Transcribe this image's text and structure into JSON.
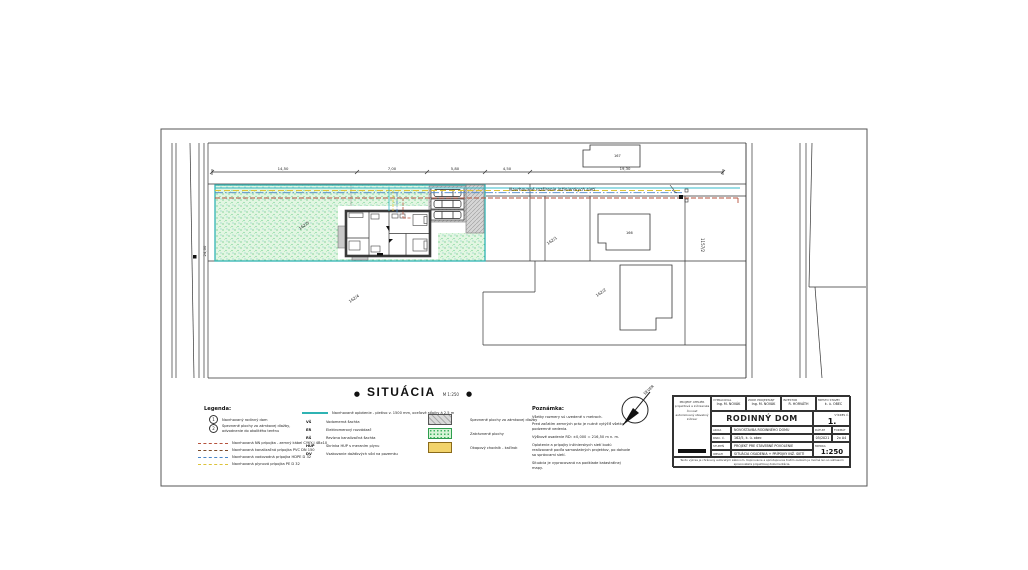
{
  "sheet": {
    "title": "SITUÁCIA",
    "scale_note": "M 1:250",
    "bullet": "●"
  },
  "drawing": {
    "street_label": "Navrhované rozšírenie inžinierskych sietí",
    "north_label": "SEVER",
    "dim_left": "24,00",
    "dims_top": [
      "14,50",
      "7,00",
      "5,80",
      "4,50",
      "19,30"
    ],
    "parcels": {
      "green": "162/5",
      "left": "162/4",
      "mid": "162/1",
      "mid2": "162/2",
      "top_building": "167",
      "building": "166",
      "road": "1157/2"
    }
  },
  "legend": {
    "header": "Legenda:",
    "numbered": [
      {
        "num": "1",
        "label": "Navrhovaný rodinný dom"
      },
      {
        "num": "2",
        "label": "Spevnené plochy zo zámkovej dlažby, odvodnenie do okolitého terénu"
      }
    ],
    "lines": [
      {
        "label": "Navrhovaná NN prípojka - zemný kábel CYKY-J 4Bx10"
      },
      {
        "label": "Navrhovaná kanalizačná prípojka PVC DN 150"
      },
      {
        "label": "Navrhovaná vodovodná prípojka HDPE D 32"
      },
      {
        "label": "Navrhovaná plynová prípojka PE D 32"
      }
    ],
    "fence_label": "Navrhované oplotenie - pletivo v. 1500 mm, oceľové stĺpiky á 2,5 m",
    "symbols": [
      {
        "sym": "VŠ",
        "label": "Vodomerná šachta"
      },
      {
        "sym": "ER",
        "label": "Elektromerový rozvádzač"
      },
      {
        "sym": "RŠ",
        "label": "Revízna kanalizačná šachta"
      },
      {
        "sym": "HUP",
        "label": "Skrinka HUP s meraním plynu"
      },
      {
        "sym": "DV",
        "label": "Vsakovanie dažďových vôd na pozemku"
      }
    ],
    "swatches": [
      {
        "label": "Spevnené plochy zo zámkovej dlažby"
      },
      {
        "label": "Zatrávnené plochy"
      },
      {
        "label": "Okapový chodník - kačírok"
      }
    ]
  },
  "notes": {
    "header": "Poznámka:",
    "items": [
      "Všetky rozmery sú uvedené v metroch.",
      "Pred začatím zemných prác je nutné vytýčiť všetky podzemné vedenia.",
      "Výškové osadenie RD: ±0,000 = 216,50 m n. m.",
      "Oplotenie a prípojky inžinierskych sietí budú realizované podľa samostatných projektov, po dohode so správcami sietí.",
      "Situácia je vypracovaná na podklade katastrálnej mapy."
    ]
  },
  "titleblock": {
    "firm": [
      "PROJEKT ATELIÉR",
      "projektová a inžinierska činnosť",
      "autorizovaný stavebný inžinier"
    ],
    "header_cells": [
      {
        "label": "VYPRACOVAL",
        "value": "Ing. M. NOVÁK"
      },
      {
        "label": "ZODP. PROJEKTANT",
        "value": "Ing. M. NOVÁK"
      },
      {
        "label": "INVESTOR",
        "value": "R. HORVÁTH"
      },
      {
        "label": "MIESTO STAVBY",
        "value": "k. ú. OBEC"
      }
    ],
    "project_title": "RODINNÝ DOM",
    "drawing_no_label": "VÝKRES Č.",
    "drawing_no": "1.",
    "rows": [
      {
        "label": "AKCIA",
        "value": "NOVOSTAVBA RODINNÉHO DOMU"
      },
      {
        "label": "PARC. Č.",
        "value": "162/5, k. ú. obec"
      },
      {
        "label": "STUPEŇ",
        "value": "PROJEKT PRE STAVEBNÉ POVOLENIE"
      },
      {
        "label": "OBSAH",
        "value": "SITUÁCIA OSADENIA + PRÍPOJKY INŽ. SIETÍ"
      }
    ],
    "date_label": "DÁTUM",
    "date": "05/2021",
    "format_label": "FORMÁT",
    "format": "2x A4",
    "scale_label": "MIERKA",
    "scale": "1:250",
    "disclaimer": "Tento výkres je chránený autorským zákonom. Kopírovanie a sprístupnenie tretím osobám je možné len so súhlasom spracovateľa projektovej dokumentácie."
  }
}
